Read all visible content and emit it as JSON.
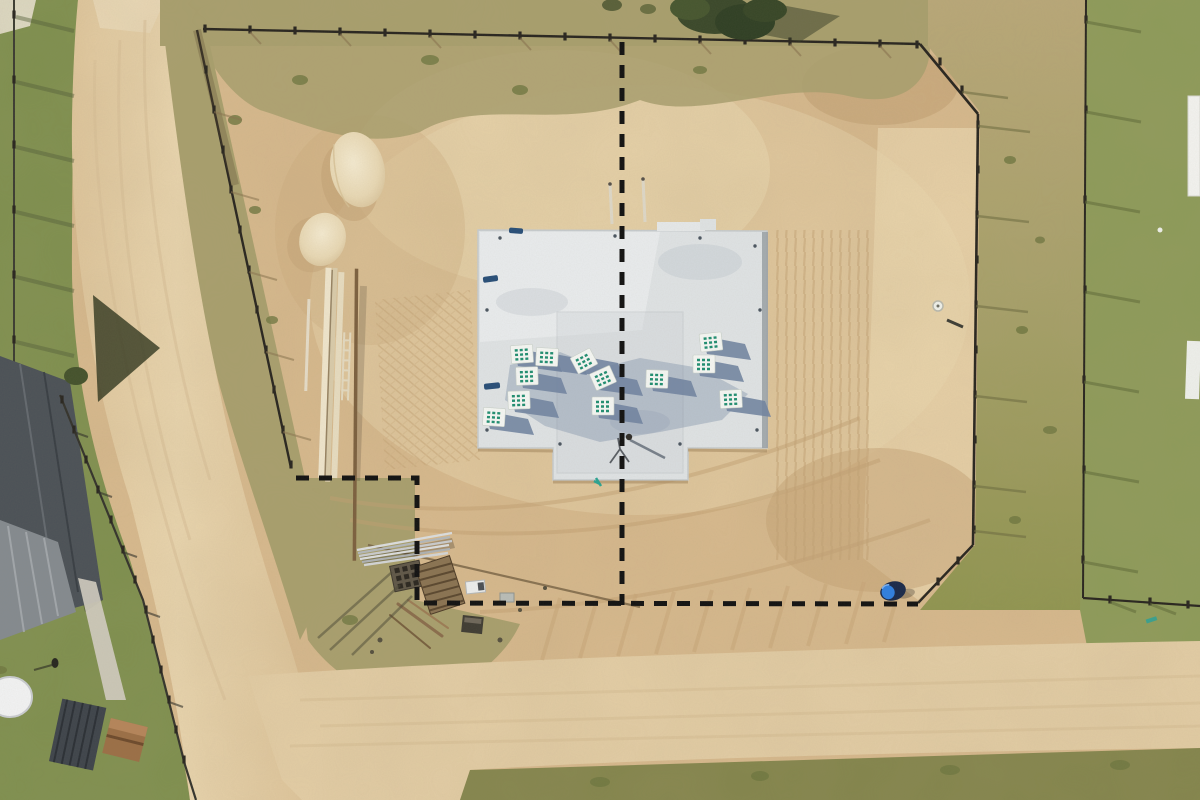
{
  "scene": {
    "type": "aerial-drone-photograph",
    "description": "Top-down aerial photo of a residential construction plot: a light concrete foundation slab loaded with white masonry-block pallets sits on cleared sandy ground. Black dashed lines mark the surveyed plot boundary (a centre line through the slab and an L-shaped corner line). Dirt roads border the lot, with neighbouring fenced gardens, a dark house roof, two sand piles, stacked lumber and scattered building materials.",
    "no_visible_text": true
  },
  "palette": {
    "dirt": "#d7b98d",
    "dirt_light": "#e8d4ac",
    "road": "#e3cda5",
    "grass_left": "#7e8f4e",
    "grass_right": "#8d9b59",
    "scrub": "#a89f6d",
    "scrub_dark": "#83854c",
    "slab": "#dfe3e5",
    "slab_bright": "#eceff0",
    "slab_shadow": "#6f83a1",
    "pallet_white": "#f5f7f4",
    "pallet_green": "#1f8e71",
    "fence": "#28251f",
    "roof_dark": "#4b5157",
    "roof_light": "#a7abaf",
    "sand": "#ecdfbf",
    "barrel_blue": "#2f7fe0",
    "barrel_dark": "#19294a",
    "dash_line": "#111111",
    "tree": "#3a482a"
  },
  "features": {
    "dashed_boundary_lines": 2,
    "foundation_slab": 1,
    "material_pallets": 12,
    "sand_piles": 2,
    "lumber_stacks": 1,
    "debris_piles": 1,
    "blue_barrel": 1,
    "survey_stakes": 2,
    "worker_on_slab": 1,
    "perimeter_fence": true,
    "neighbour_house_roof": 1,
    "dirt_roads": 2
  }
}
